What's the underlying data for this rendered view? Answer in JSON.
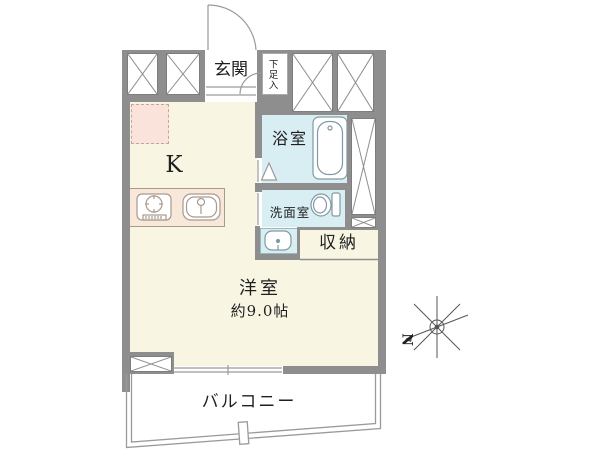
{
  "title": "apartment-floor-plan",
  "colors": {
    "wall": "#8e8e8e",
    "floor": "#f8f6e3",
    "wet": "#d8eef2",
    "counter": "#f8e8da",
    "fridge": "#f9e3da",
    "line": "#9a9a9a",
    "outline": "#7d7d7d",
    "text": "#1f1f1f"
  },
  "rooms": {
    "entrance": {
      "label": "玄関"
    },
    "shoe_cabinet": {
      "label": "下足入"
    },
    "bathroom": {
      "label": "浴室"
    },
    "washroom": {
      "label": "洗面室"
    },
    "storage": {
      "label": "収納"
    },
    "kitchen": {
      "label": "K"
    },
    "main_room": {
      "label": "洋室",
      "area": "約9.0帖"
    },
    "balcony": {
      "label": "バルコニー"
    }
  },
  "compass": {
    "north_label": "N"
  }
}
